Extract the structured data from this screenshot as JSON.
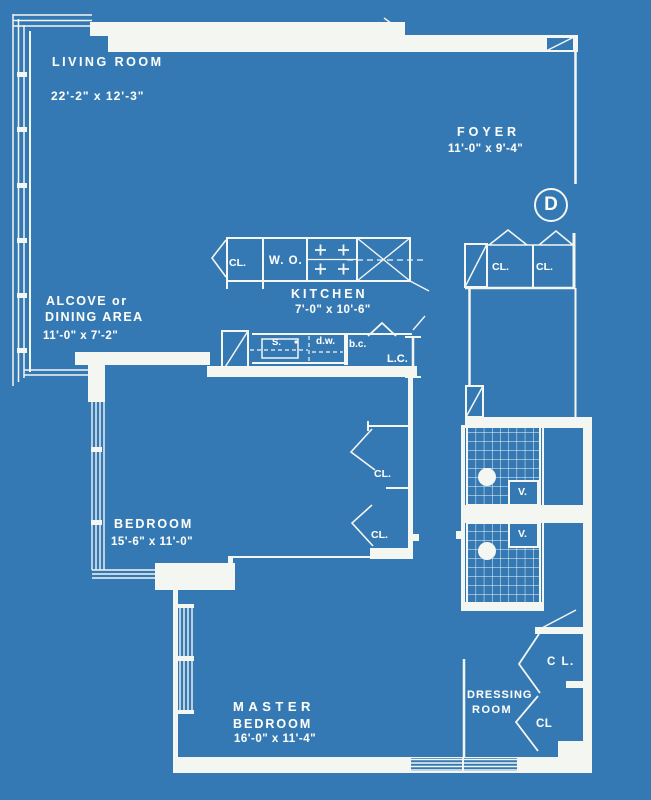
{
  "unit": {
    "letter": "D"
  },
  "rooms": {
    "living_room": {
      "name": "LIVING ROOM",
      "dims": "22'-2\" x 12'-3\""
    },
    "foyer": {
      "name": "FOYER",
      "dims": "11'-0\" x 9'-4\""
    },
    "kitchen": {
      "name": "KITCHEN",
      "dims": "7'-0\" x 10'-6\""
    },
    "alcove": {
      "name_line1": "ALCOVE or",
      "name_line2": "DINING AREA",
      "dims": "11'-0\" x 7'-2\""
    },
    "bedroom": {
      "name": "BEDROOM",
      "dims": "15'-6\" x 11'-0\""
    },
    "master_bedroom": {
      "name_line1": "MASTER",
      "name_line2": "BEDROOM",
      "dims": "16'-0\" x 11'-4\""
    },
    "dressing_room": {
      "name_line1": "DRESSING",
      "name_line2": "ROOM"
    }
  },
  "labels": {
    "kitchen_closet": "CL.",
    "wall_oven": "W. O.",
    "sink": "S.",
    "dishwasher": "d.w.",
    "base_cabinet": "b.c.",
    "linen_closet": "L.C.",
    "foyer_closet_1": "CL.",
    "foyer_closet_2": "CL.",
    "bedroom_closet_1": "CL.",
    "bedroom_closet_2": "CL.",
    "vanity_1": "V.",
    "vanity_2": "V.",
    "dressing_closet_1": "C L.",
    "dressing_closet_2": "CL"
  },
  "colors": {
    "background": "#3478b4",
    "line": "#f4f6f2",
    "text": "#fafcf8"
  }
}
